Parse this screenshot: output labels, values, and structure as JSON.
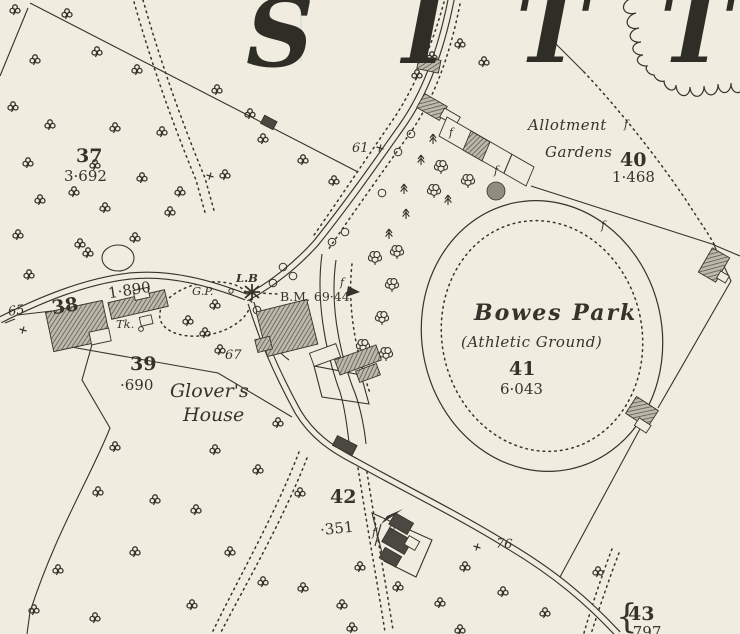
{
  "colors": {
    "paper": "#f0ecdf",
    "ink": "#35332b",
    "building_dark": "#4a4840",
    "letter": "#2e2d26"
  },
  "big_letters": {
    "l1": "S",
    "l2": "I",
    "l3": "T",
    "l4": "T"
  },
  "labels": {
    "parcel37_num": "37",
    "parcel37_area": "3·692",
    "parcel38_num": "38",
    "parcel38_area": "1·890",
    "parcel39_num": "39",
    "parcel39_area": "·690",
    "parcel40_num": "40",
    "parcel40_area": "1·468",
    "parcel41_num": "41",
    "parcel41_area": "6·043",
    "parcel42_num": "42",
    "parcel42_area": "·351",
    "parcel43_num": "43",
    "parcel43_area": "·797",
    "road_61": "61",
    "road_65": "65",
    "road_67": "67",
    "road_76": "76",
    "allotment_line1": "Allotment",
    "allotment_line2": "Gardens",
    "bowes_line1": "Bowes Park",
    "bowes_line2": "(Athletic Ground)",
    "glovers_line1": "Glover's",
    "glovers_line2": "House",
    "letter_box": "L.B",
    "guide_post": "G.P.",
    "bench_mark": "B.M. 69·44",
    "tank": "Tk.",
    "brace": "{",
    "fence_mark": "f"
  }
}
